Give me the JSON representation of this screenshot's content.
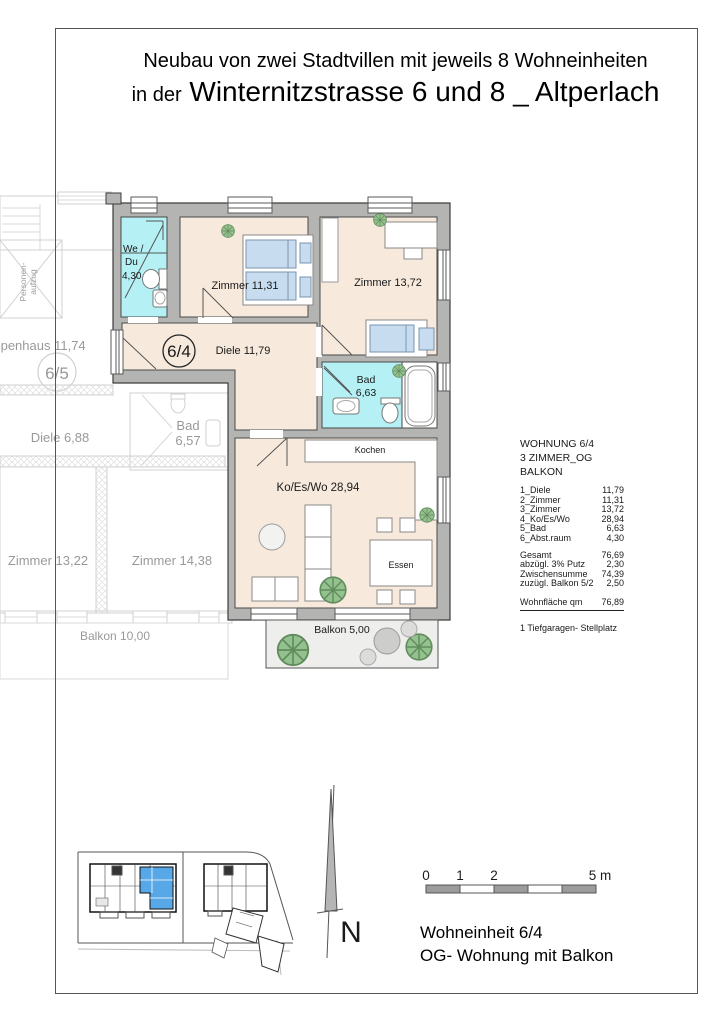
{
  "title": {
    "line1": "Neubau von zwei Stadtvillen mit jeweils 8 Wohneinheiten",
    "line2_small": "in der",
    "line2_large": "Winternitzstrasse 6 und 8 _ Altperlach"
  },
  "main_unit": {
    "badge": "6/4",
    "we_du_l1": "We /",
    "we_du_l2": "Du",
    "we_du_l3": "4,30",
    "zimmer2": "Zimmer 11,31",
    "zimmer3": "Zimmer 13,72",
    "diele": "Diele 11,79",
    "bad_l1": "Bad",
    "bad_l2": "6,63",
    "wohnen": "Ko/Es/Wo 28,94",
    "kochen": "Kochen",
    "essen": "Essen",
    "balkon": "Balkon 5,00"
  },
  "neighbor_unit": {
    "badge": "6/5",
    "treppenhaus": "Treppenhaus 11,74",
    "aufzug_l1": "Personen-",
    "aufzug_l2": "aufzug",
    "diele": "Diele 6,88",
    "bad_l1": "Bad",
    "bad_l2": "6,57",
    "zimmer1": "Zimmer 13,22",
    "zimmer2": "Zimmer 14,38",
    "balkon": "Balkon 10,00"
  },
  "info_panel": {
    "heading_l1": "WOHNUNG 6/4",
    "heading_l2": "3 ZIMMER_OG",
    "heading_l3": "BALKON",
    "rooms": [
      {
        "label": "1_Diele",
        "value": "11,79"
      },
      {
        "label": "2_Zimmer",
        "value": "11,31"
      },
      {
        "label": "3_Zimmer",
        "value": "13,72"
      },
      {
        "label": "4_Ko/Es/Wo",
        "value": "28,94"
      },
      {
        "label": "5_Bad",
        "value": "6,63"
      },
      {
        "label": "6_Abst.raum",
        "value": "4,30"
      }
    ],
    "summary": [
      {
        "label": "Gesamt",
        "value": "76,69"
      },
      {
        "label": "abzügl. 3% Putz",
        "value": "2,30"
      },
      {
        "label": "Zwischensumme",
        "value": "74,39"
      },
      {
        "label": "zuzügl. Balkon 5/2",
        "value": "2,50"
      }
    ],
    "total": {
      "label": "Wohnfläche qm",
      "value": "76,89"
    },
    "note": "1 Tiefgaragen- Stellplatz"
  },
  "footer": {
    "scale": {
      "t0": "0",
      "t1": "1",
      "t2": "2",
      "t5": "5 m"
    },
    "north": "N",
    "caption_l1": "Wohneinheit 6/4",
    "caption_l2": "OG- Wohnung mit Balkon"
  },
  "colors": {
    "room_fill": "#f7eadd",
    "wet_room_fill": "#b5f0f4",
    "wall_fill": "#b4b4b3",
    "furniture_blue": "#c8dcf0",
    "balcony_fill": "#eeeeec",
    "highlight_blue": "#58a8e8"
  }
}
